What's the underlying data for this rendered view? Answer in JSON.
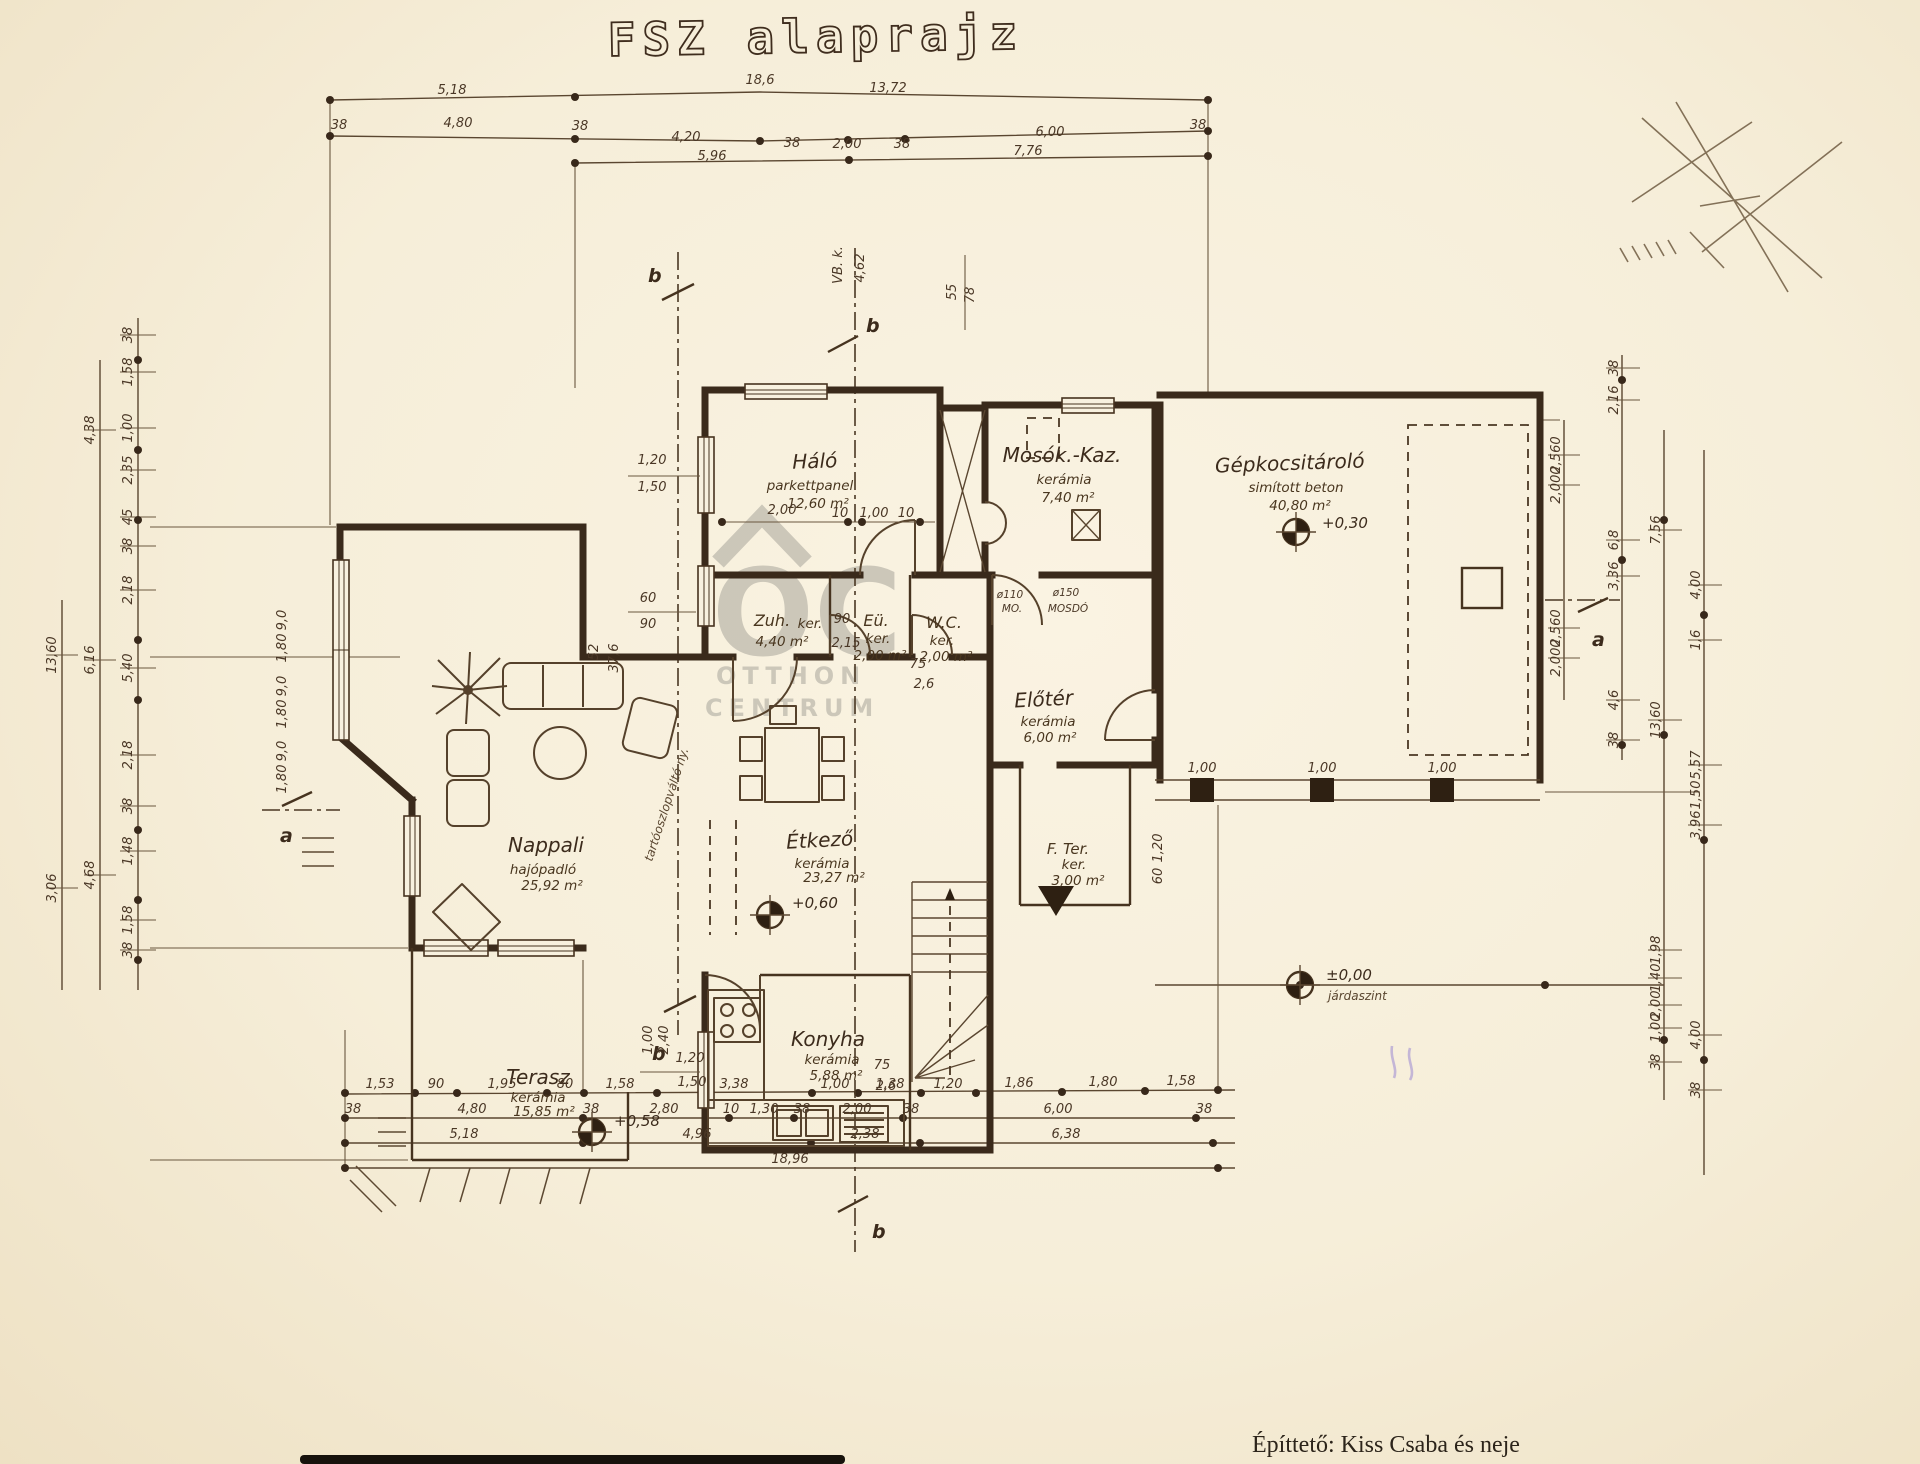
{
  "meta": {
    "title": "FSZ alaprajz",
    "footer": "Építtető: Kiss Csaba és neje"
  },
  "watermark": {
    "line1": "OC",
    "line2": "OTTHON",
    "line3": "CENTRUM"
  },
  "rooms": {
    "halo": {
      "name": "Háló",
      "floor": "parkettpanel",
      "area": "12,60 m²"
    },
    "mosok": {
      "name": "Mosók.-Kaz.",
      "floor": "kerámia",
      "area": "7,40 m²"
    },
    "garazs": {
      "name": "Gépkocsitároló",
      "floor": "simított beton",
      "area": "40,80 m²"
    },
    "zuh": {
      "name": "Zuh.",
      "floor": "ker.",
      "area": "4,40 m²"
    },
    "eu": {
      "name": "Eü.",
      "floor": "ker.",
      "area": "2,00 m²"
    },
    "wc": {
      "name": "W.C.",
      "floor": "ker.",
      "area": "2,00 m²"
    },
    "eloter": {
      "name": "Előtér",
      "floor": "kerámia",
      "area": "6,00 m²"
    },
    "fter": {
      "name": "F. Ter.",
      "floor": "ker.",
      "area": "3,00 m²"
    },
    "nappali": {
      "name": "Nappali",
      "floor": "hajópadló",
      "area": "25,92 m²"
    },
    "etkezo": {
      "name": "Étkező",
      "floor": "kerámia",
      "area": "23,27 m²"
    },
    "konyha": {
      "name": "Konyha",
      "floor": "kerámia",
      "area": "5,88 m²"
    },
    "terasz": {
      "name": "Terasz",
      "floor": "kerámia",
      "area": "15,85 m²"
    }
  },
  "levels": {
    "etkezo": "+0,60",
    "terasz": "+0,58",
    "garazs": "+0,30",
    "jarda": "±0,00",
    "jarda_label": "járdaszint"
  },
  "sections": {
    "a": "a",
    "b": "b"
  },
  "dims": {
    "top1": [
      "5,18",
      "18,6",
      "13,72"
    ],
    "top2": [
      "38",
      "4,80",
      "38",
      "4,20",
      "38",
      "2,00",
      "38",
      "6,00",
      "38"
    ],
    "top3": [
      "5,96",
      "7,76"
    ],
    "bottom1": [
      "1,53",
      "90",
      "1,95",
      "80",
      "1,58",
      "3,38",
      "1,00",
      "1,38",
      "1,20",
      "1,86",
      "1,80",
      "1,58"
    ],
    "bottom2": [
      "38",
      "4,80",
      "38",
      "2,80",
      "10",
      "1,30",
      "38",
      "2,00",
      "38",
      "6,00",
      "38"
    ],
    "bottom3": [
      "5,18",
      "4,96",
      "2,38",
      "6,38"
    ],
    "bottom4": [
      "18,96"
    ],
    "left_outer": [
      "13,60",
      "3,06"
    ],
    "left_mid": [
      "4,38",
      "6,16",
      "4,68"
    ],
    "left_inner": [
      "38",
      "1,58",
      "1,00",
      "2,35",
      "45",
      "38",
      "2,18",
      "5,40",
      "2,18",
      "38",
      "1,48",
      "1,58",
      "38"
    ],
    "left_windows": [
      "9,0",
      "1,80",
      "9,0",
      "1,80",
      "9,0",
      "1,80"
    ],
    "right_garage": [
      "2,560",
      "2,000",
      "2,560",
      "2,000"
    ],
    "right_inner": [
      "38",
      "2,16",
      "6,8",
      "3,36",
      "4,6",
      "38"
    ],
    "right_mid": [
      "7,56",
      "13,60",
      "1,98",
      "1,40",
      "2,00",
      "1,00",
      "38"
    ],
    "right_outer": [
      "4,00",
      "1,6",
      "5,57",
      "1,50",
      "3,96",
      "4,00",
      "38"
    ],
    "inner": {
      "halo_win": [
        "1,20",
        "1,50"
      ],
      "halo_chain": [
        "2,00",
        "10",
        "1,00",
        "10"
      ],
      "zuh_win": [
        "60",
        "90"
      ],
      "door1": [
        "90",
        "2,15"
      ],
      "wc_door": [
        "75",
        "2,6"
      ],
      "etkezo_beam": [
        "52",
        "37,6"
      ],
      "konyha_v": [
        "1,00",
        "2,40"
      ],
      "konyha_win": [
        "1,20",
        "1,50"
      ],
      "konyha_door": [
        "75",
        "2,6"
      ],
      "pillars": [
        "1,00",
        "1,00",
        "1,00"
      ],
      "pergola_v": [
        "1,20",
        "60"
      ],
      "shaft": [
        "55",
        "78"
      ],
      "vb": [
        "VB. k.",
        "4,62"
      ]
    }
  },
  "fixtures": {
    "mo": "ø110",
    "mo2": "MO.",
    "mosdo": "ø150",
    "mosdo2": "MOSDÓ"
  },
  "annotations": {
    "beam_note": "tartóoszlopváltó ny."
  }
}
